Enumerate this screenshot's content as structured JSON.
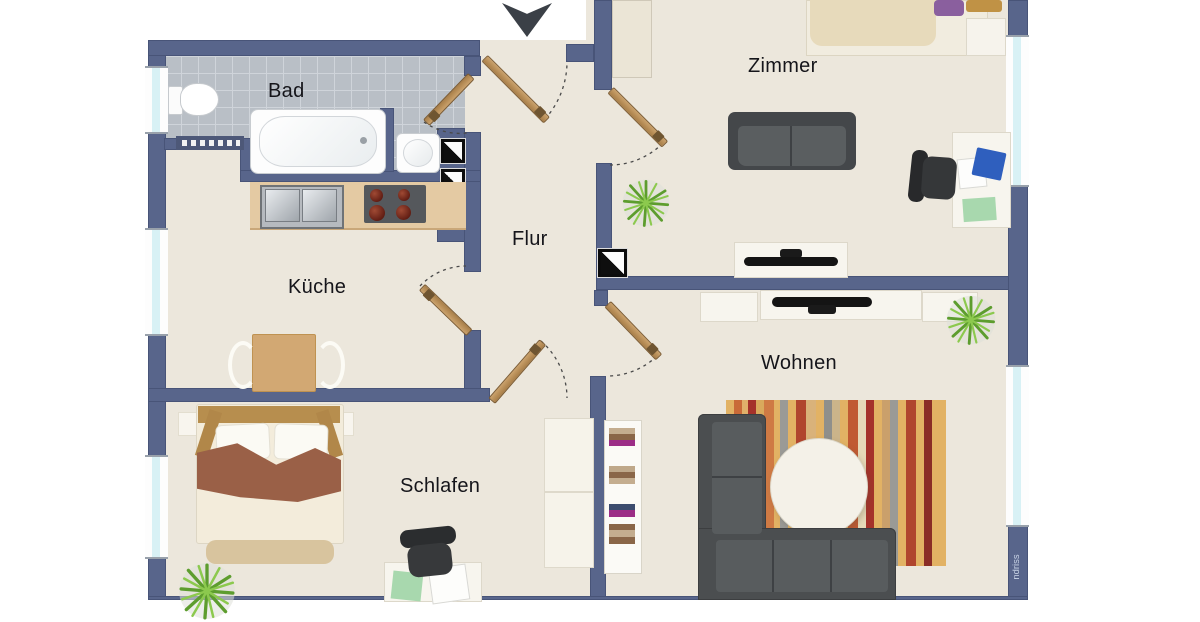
{
  "rooms": {
    "bad": {
      "label": "Bad"
    },
    "kueche": {
      "label": "Küche"
    },
    "flur": {
      "label": "Flur"
    },
    "zimmer": {
      "label": "Zimmer"
    },
    "wohnen": {
      "label": "Wohnen"
    },
    "schlafen": {
      "label": "Schlafen"
    }
  },
  "watermark": {
    "text": "ndriss"
  },
  "symbols": {
    "entrance_arrow": "down-arrow",
    "door": "wood-door-leaf-with-dashed-swing-arc",
    "shaft": "black-white-diagonal-square",
    "plant": "potted-plant-top-view",
    "window": "light-blue-window-strip",
    "radiator": "dotted-wall-block"
  },
  "colors": {
    "wall": "#58658b",
    "floor": "#ece7dc",
    "tile": "#b9bfc6",
    "window_glass": "#d8f1f5",
    "door_wood": "#b8905a",
    "counter": "#e4caa3",
    "sofa": "#4b4e50",
    "rug": "#e2b264",
    "plant": "#69aa34",
    "blanket": "#9a6047",
    "headboard_wood": "#b78e4e",
    "arrow": "#3b4047"
  }
}
